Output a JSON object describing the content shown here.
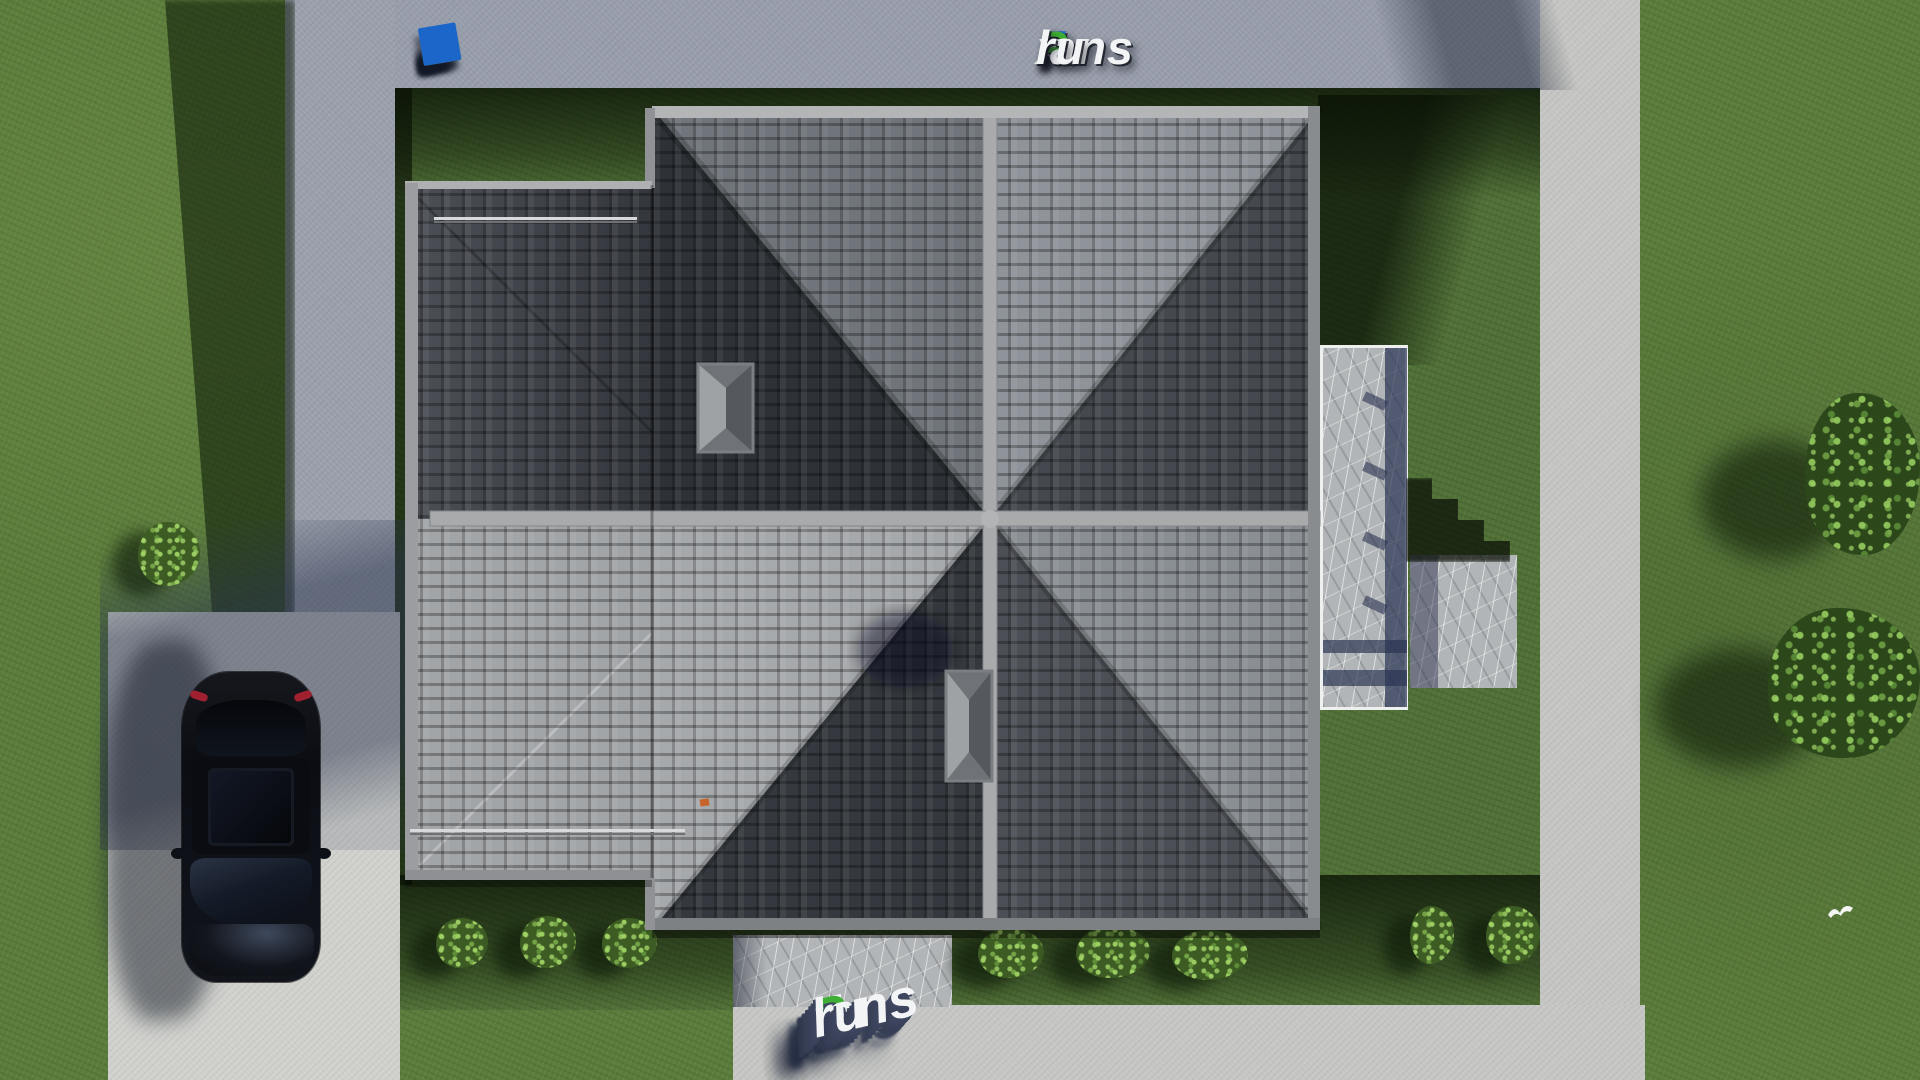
{
  "brand": {
    "name": "FixPlans.ru"
  },
  "logo_top": {
    "f": "F",
    "i": "i",
    "x": "x",
    "p": "P",
    "lans": "lans",
    "dot": ".",
    "ru": "ru"
  },
  "watermark_bottom": {
    "f": "F",
    "i": "i",
    "x": "x",
    "p": "P",
    "lans": "lans",
    "dot": ".",
    "ru": "ru"
  },
  "watermark_top_left": {
    "text": "FixPlans.ru"
  },
  "palette": {
    "brand_blue": "#1d66c9",
    "brand_green": "#3aa832",
    "text_white": "#f3f4f5",
    "grass": "#5b7c3c",
    "grass_shadow": "#16290c",
    "concrete_blue_path": "#979daa",
    "concrete_light_path": "#c6c7c4",
    "driveway": "#d0d1cd",
    "stone_terrace": "#b2b5b7",
    "roof_tile_dark": "#2e3237",
    "roof_tile_medium": "#70757b",
    "roof_tile_light": "#a6a9ac",
    "ridge_cap": "#a8aaac",
    "pergola_shadow": "#2a3352",
    "car_body": "#0b0d12",
    "taillight_red": "#a12030",
    "roof_vent_orange": "#c8642a"
  }
}
